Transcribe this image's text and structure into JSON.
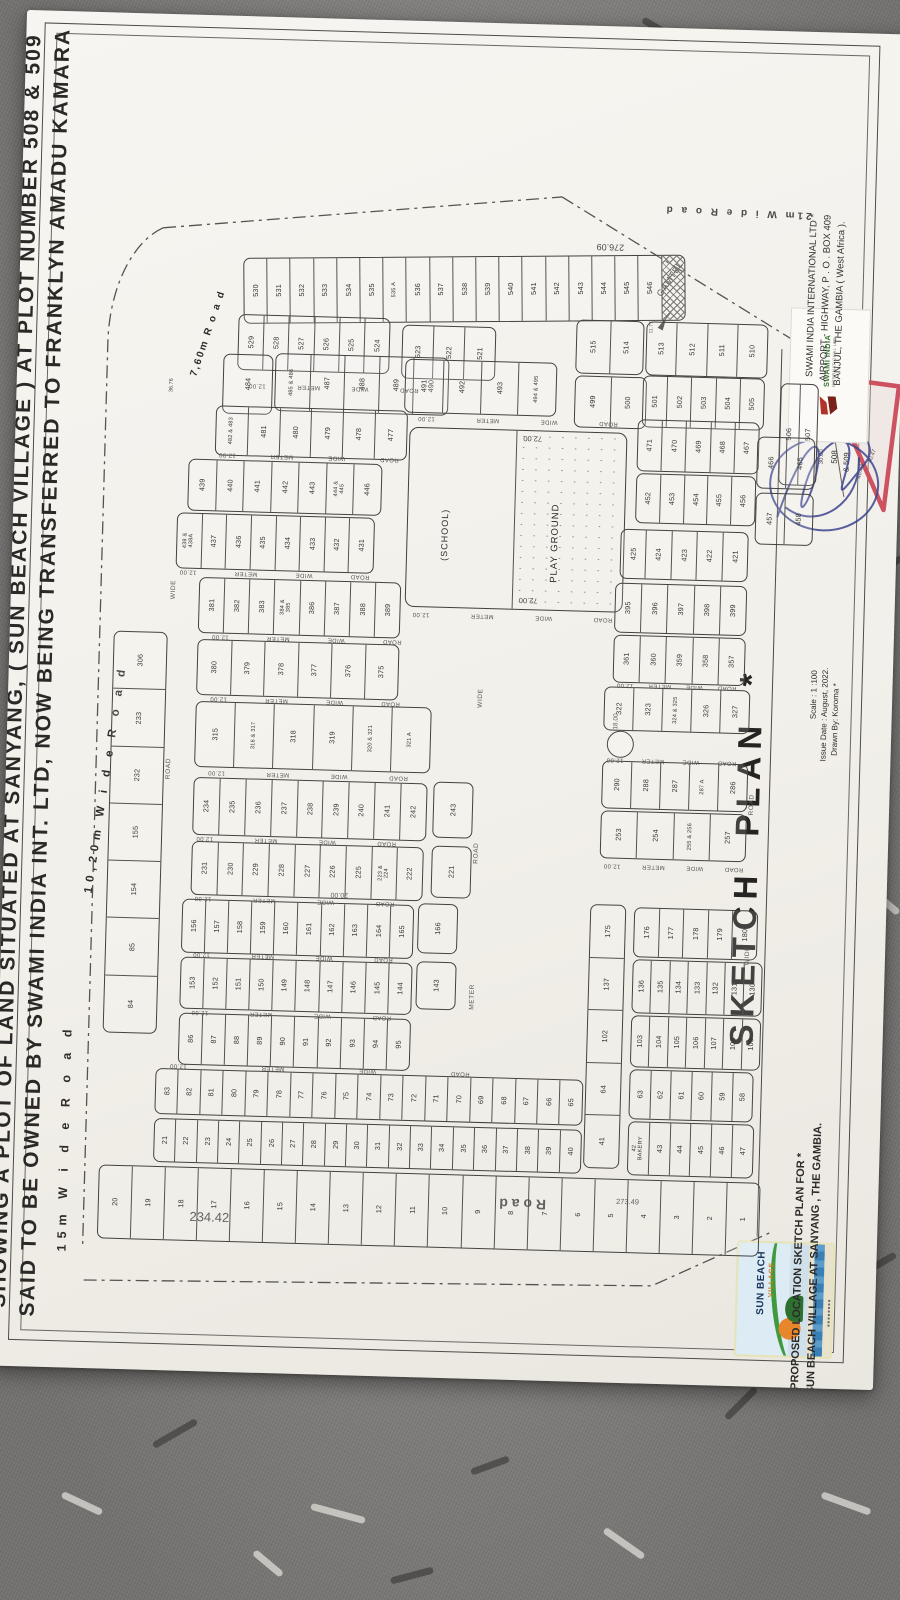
{
  "title": {
    "line1": "SHOWING A PLOT OF LAND SITUATED AT SANYANG, ( SUN BEACH VILLAGE ) AT PLOT NUMBER 508 & 509",
    "line2": "SAID TO BE OWNED BY SWAMI INDIA INT. LTD, NOW BEING TRANSFERRED TO FRANKLYN  AMADU  KAMARA"
  },
  "sketch_block": {
    "heading": "SKETCH  PLAN  *",
    "scale": "Scale :  1 :100",
    "issue_date": "Issue Date :  August,  2022.",
    "drawn_by": "Drawn By:  Koroma  *"
  },
  "footer": {
    "caption1": "PROPOSED  LOCATION  SKETCH PLAN  FOR   *",
    "caption2": "SUN BEACH VILLAGE  AT  SANYANG , THE  GAMBIA."
  },
  "swami": {
    "logo_name": "SWAMI INDIA",
    "logo_sub": "INTERNATIONAL LTD",
    "addr1": "SWAMI INDIA  INTERNATIONAL LTD *",
    "addr2": "AIRPORT - HIGHWAY, P . O . BOX 409",
    "addr3": "BANJUL, THE GAMBIA ( West Africa )."
  },
  "sunbeach": {
    "name": "SUN BEACH",
    "sub": "VILLAGE"
  },
  "plan": {
    "road_words": [
      "ROAD",
      "WIDE",
      "METER",
      "12.00"
    ],
    "road_names": {
      "left_edge": "15m   W   i   d   e        R   o   a   d",
      "left_mid": "10,20m   W  i  d  e      R  o  a  d",
      "top_right": "21m     W   i   d   e        R   o   a   d",
      "top_small": "7,60m   R  o  a  d",
      "bottom_big": "R        o        a        d"
    },
    "dims": {
      "bottom": "234.42",
      "bottom_right": "273.49",
      "top": "276.09",
      "block_20": "20.00",
      "school_top": "72.00",
      "school_bottom": "72.00",
      "road_18": "18.00",
      "plot484_side": "36.76",
      "gamtel_side": "11.77"
    },
    "gamtel": "GAMTEL",
    "school": {
      "left_label": "(SCHOOL)",
      "right_label": "PLAY GROUND"
    },
    "triangle": {
      "dim_a": "30.00",
      "plot": "508",
      "plot2": "& 509",
      "dim_b": "46.04",
      "dim_c": "40.47"
    },
    "strips": [
      {
        "id": "s530",
        "cells": [
          "530",
          "531",
          "532",
          "533",
          "534",
          "535",
          "535 A",
          "536",
          "537",
          "538",
          "539",
          "540",
          "541",
          "542",
          "543",
          "544",
          "545",
          "546"
        ],
        "hatch": true
      },
      {
        "id": "s529",
        "cells": [
          "529",
          "528",
          "527",
          "526",
          "525",
          "524"
        ]
      },
      {
        "id": "s523",
        "cells": [
          "523",
          "522",
          "521"
        ]
      },
      {
        "id": "s515",
        "cells": [
          "515",
          "514"
        ]
      },
      {
        "id": "s513",
        "cells": [
          "513",
          "512",
          "511",
          "510"
        ]
      },
      {
        "id": "s499",
        "cells": [
          "499",
          "500"
        ]
      },
      {
        "id": "s501",
        "cells": [
          "501",
          "502",
          "503",
          "504",
          "505"
        ]
      },
      {
        "id": "s506",
        "cells": [
          "506",
          "507"
        ]
      },
      {
        "id": "s484",
        "cells": [
          "484"
        ]
      },
      {
        "id": "s485",
        "cells": [
          "485 & 486",
          "487",
          "488",
          "489",
          "490"
        ]
      },
      {
        "id": "s491",
        "cells": [
          "491",
          "492",
          "493",
          "494 & 495"
        ]
      },
      {
        "id": "s482",
        "cells": [
          "482 & 483",
          "481",
          "480",
          "479",
          "478",
          "477"
        ]
      },
      {
        "id": "s471",
        "cells": [
          "471",
          "470",
          "469",
          "468",
          "467"
        ]
      },
      {
        "id": "s466",
        "cells": [
          "466",
          "465"
        ]
      },
      {
        "id": "s439",
        "cells": [
          "439",
          "440",
          "441",
          "442",
          "443",
          "444 & 445",
          "446"
        ]
      },
      {
        "id": "s452",
        "cells": [
          "452",
          "453",
          "454",
          "455",
          "456"
        ]
      },
      {
        "id": "s457",
        "cells": [
          "457",
          "458"
        ]
      },
      {
        "id": "s438",
        "cells": [
          "438 & 438A",
          "437",
          "436",
          "435",
          "434",
          "433",
          "432",
          "431"
        ]
      },
      {
        "id": "s425",
        "cells": [
          "425",
          "424",
          "423",
          "422",
          "421"
        ]
      },
      {
        "id": "s381",
        "cells": [
          "381",
          "382",
          "383",
          "384 & 385",
          "386",
          "387",
          "388",
          "389"
        ]
      },
      {
        "id": "s395",
        "cells": [
          "395",
          "396",
          "397",
          "398",
          "399"
        ]
      },
      {
        "id": "s380",
        "cells": [
          "380",
          "379",
          "378",
          "377",
          "376",
          "375"
        ]
      },
      {
        "id": "s361",
        "cells": [
          "361",
          "360",
          "359",
          "358",
          "357"
        ]
      },
      {
        "id": "s322",
        "cells": [
          "322",
          "323",
          "324 & 325",
          "326",
          "327"
        ]
      },
      {
        "id": "s315",
        "cells": [
          "315",
          "316 & 317",
          "318",
          "319",
          "320 & 321",
          "321 A"
        ]
      },
      {
        "id": "s290",
        "cells": [
          "290",
          "288",
          "287",
          "287 A",
          "286"
        ]
      },
      {
        "id": "s253",
        "cells": [
          "253",
          "254",
          "255 & 256",
          "257"
        ]
      },
      {
        "id": "s234",
        "cells": [
          "234",
          "235",
          "236",
          "237",
          "238",
          "239",
          "240",
          "241",
          "242"
        ]
      },
      {
        "id": "s243",
        "cells": [
          "243"
        ]
      },
      {
        "id": "s231",
        "cells": [
          "231",
          "230",
          "229",
          "228",
          "227",
          "226",
          "225",
          "223 & 224",
          "222"
        ]
      },
      {
        "id": "s221",
        "cells": [
          "221"
        ]
      },
      {
        "id": "s156",
        "cells": [
          "156",
          "157",
          "158",
          "159",
          "160",
          "161",
          "162",
          "163",
          "164",
          "165"
        ]
      },
      {
        "id": "s166",
        "cells": [
          "166"
        ]
      },
      {
        "id": "s153",
        "cells": [
          "153",
          "152",
          "151",
          "150",
          "149",
          "148",
          "147",
          "146",
          "145",
          "144"
        ]
      },
      {
        "id": "s143",
        "cells": [
          "143"
        ]
      },
      {
        "id": "s86",
        "cells": [
          "86",
          "87",
          "88",
          "89",
          "90",
          "91",
          "92",
          "93",
          "94",
          "95"
        ]
      },
      {
        "id": "s83",
        "cells": [
          "83",
          "82",
          "81",
          "80",
          "79",
          "78",
          "77",
          "76",
          "75",
          "74",
          "73",
          "72",
          "71",
          "70",
          "69",
          "68",
          "67",
          "66",
          "65"
        ]
      },
      {
        "id": "s21",
        "cells": [
          "21",
          "22",
          "23",
          "24",
          "25",
          "26",
          "27",
          "28",
          "29",
          "30",
          "31",
          "32",
          "33",
          "34",
          "35",
          "36",
          "37",
          "38",
          "39",
          "40"
        ]
      },
      {
        "id": "sbot",
        "cells": [
          "20",
          "19",
          "18",
          "17",
          "16",
          "15",
          "14",
          "13",
          "12",
          "11",
          "10",
          "9",
          "8",
          "7",
          "6",
          "5",
          "4",
          "3",
          "2",
          "1"
        ]
      },
      {
        "id": "lcol",
        "cells": [
          "306",
          "233",
          "232",
          "155",
          "154",
          "85",
          "84"
        ]
      },
      {
        "id": "rcol",
        "cells": [
          "175",
          "137",
          "102",
          "64",
          "41"
        ]
      },
      {
        "id": "r176",
        "cells": [
          "176",
          "177",
          "178",
          "179",
          "180"
        ]
      },
      {
        "id": "r136",
        "cells": [
          "136",
          "135",
          "134",
          "133",
          "132",
          "131",
          "130"
        ]
      },
      {
        "id": "r103",
        "cells": [
          "103",
          "104",
          "105",
          "106",
          "107",
          "108",
          "109"
        ]
      },
      {
        "id": "r63",
        "cells": [
          "63",
          "62",
          "61",
          "60",
          "59",
          "58"
        ]
      },
      {
        "id": "r42",
        "cells": [
          "42\nBAKERY",
          "43",
          "44",
          "45",
          "46",
          "47"
        ]
      }
    ]
  }
}
